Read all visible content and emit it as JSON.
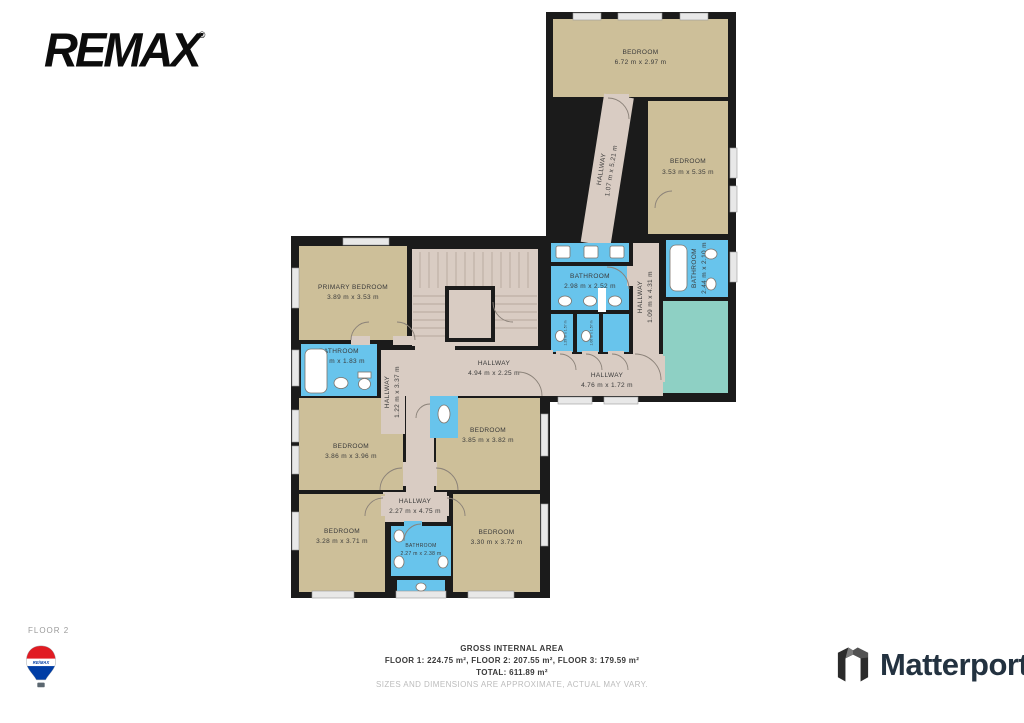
{
  "branding": {
    "remax_wordmark": "REMAX",
    "remax_trademark": "®",
    "matterport_label": "Matterport",
    "balloon_text": "RE/MAX"
  },
  "floor_label": "FLOOR 2",
  "footer": {
    "title": "GROSS INTERNAL AREA",
    "areas_line": "FLOOR 1: 224.75 m², FLOOR 2: 207.55 m², FLOOR 3: 179.59 m²",
    "total_line": "TOTAL: 611.89 m²",
    "disclaimer": "SIZES AND DIMENSIONS ARE APPROXIMATE, ACTUAL MAY VARY."
  },
  "colors": {
    "wall": "#1b1b1b",
    "room_tan": "#cdbf99",
    "hallway_pink": "#d9ccc3",
    "bathroom_blue": "#68c4ec",
    "deck_teal": "#8ed0c4",
    "remax_red": "#e11b22",
    "remax_blue": "#003da5",
    "matterport_dark": "#233240"
  },
  "rooms": {
    "bedroom_top": {
      "name": "BEDROOM",
      "dims": "6.72 m x 2.97 m"
    },
    "bedroom_right": {
      "name": "BEDROOM",
      "dims": "3.53 m x 5.35 m"
    },
    "hallway_diag": {
      "name": "HALLWAY",
      "dims": "1.07 m x 5.21 m"
    },
    "bathroom_mid": {
      "name": "BATHROOM",
      "dims": "2.98 m x 2.52 m"
    },
    "stall_left": {
      "name": "",
      "dims": "1.29 m x 1.57 m"
    },
    "stall_mid": {
      "name": "",
      "dims": "1.06 m x 1.57 m"
    },
    "hallway_vert": {
      "name": "HALLWAY",
      "dims": "1.09 m x 4.31 m"
    },
    "bathroom_right": {
      "name": "BATHROOM",
      "dims": "2.44 m x 2.10 m"
    },
    "hallway_bottom": {
      "name": "HALLWAY",
      "dims": "4.76 m x 1.72 m"
    },
    "primary_bedroom": {
      "name": "PRIMARY BEDROOM",
      "dims": "3.89 m x 3.53 m"
    },
    "hallway_main": {
      "name": "HALLWAY",
      "dims": "4.94 m x 2.25 m"
    },
    "bathroom_left": {
      "name": "BATHROOM",
      "dims": "2.69 m x 1.83 m"
    },
    "hallway_122": {
      "name": "HALLWAY",
      "dims": "1.22 m x 3.37 m"
    },
    "bedroom_mid_left": {
      "name": "BEDROOM",
      "dims": "3.86 m x 3.96 m"
    },
    "bedroom_mid_right": {
      "name": "BEDROOM",
      "dims": "3.85 m x 3.82 m"
    },
    "hallway_227": {
      "name": "HALLWAY",
      "dims": "2.27 m x 4.75 m"
    },
    "bedroom_bot_left": {
      "name": "BEDROOM",
      "dims": "3.28 m x 3.71 m"
    },
    "bathroom_bottom": {
      "name": "BATHROOM",
      "dims": "2.27 m x 2.38 m"
    },
    "bedroom_bot_right": {
      "name": "BEDROOM",
      "dims": "3.30 m x 3.72 m"
    }
  }
}
